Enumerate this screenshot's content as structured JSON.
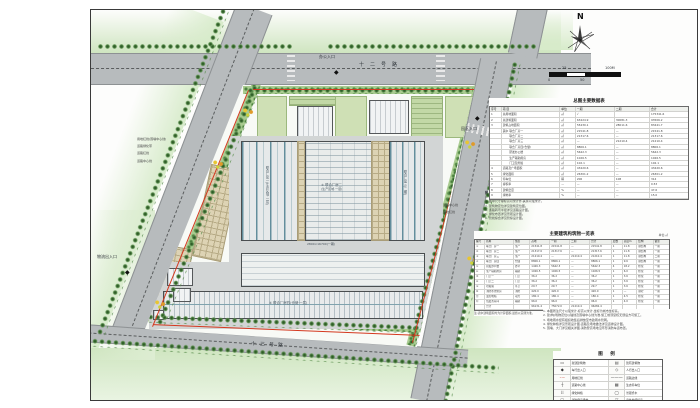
{
  "sheet": {
    "compass": {
      "north_label": "N"
    },
    "scalebar": {
      "label_0": "0",
      "label_25": "25",
      "label_50": "50",
      "label_100": "100M"
    },
    "plan": {
      "road_top": "十二号路",
      "road_bottom": "十三号路",
      "entrance_office": "办公入口",
      "entrance_park": "园区入口",
      "entrance_logistics": "物流出入口",
      "left_leaders": [
        "用地红线(围墙中心线)",
        "道路绿化带",
        "道路红线",
        "道路中心线"
      ],
      "right_leaders": [
        "道路中心线",
        "用地红线"
      ],
      "f1_label": "联合厂房一(生产区域·一层)",
      "f2_label_1": "② 联合厂房二",
      "f2_label_2": "(生产区域·一层)",
      "f3_label": "联合厂房三(二期)",
      "f4_label": "④ 联合厂房四(仓储·一层)",
      "yard_dim": "2800×16700(一期)"
    },
    "table1": {
      "title": "总图主要数据表",
      "rows": [
        [
          "序号",
          "项  目",
          "单位",
          "一期",
          "二期",
          "合计"
        ],
        [
          "1",
          "总用地面积",
          "㎡",
          "√",
          "",
          "175341.6"
        ],
        [
          "2",
          "总建筑面积",
          "㎡",
          "63424.9",
          "30081.3",
          "93506.2"
        ],
        [
          "3",
          "建筑占地面积",
          "㎡",
          "55430.1",
          "28011.6",
          "83441.7"
        ],
        [
          "",
          "其中 联合厂房一",
          "㎡",
          "21541.8",
          "—",
          "21541.8"
        ],
        [
          "",
          "　　 联合厂房二",
          "㎡",
          "21317.6",
          "—",
          "21317.6"
        ],
        [
          "",
          "　　 联合厂房三",
          "㎡",
          "—",
          "21210.4",
          "21210.4"
        ],
        [
          "",
          "　　 联合厂房四(仓储)",
          "㎡",
          "8806.1",
          "—",
          "8806.1"
        ],
        [
          "",
          "　　 研发办公楼",
          "㎡",
          "5642.3",
          "—",
          "5642.3"
        ],
        [
          "",
          "　　 生产辅助用房",
          "㎡",
          "1026.5",
          "—",
          "1026.5"
        ],
        [
          "",
          "　　 门卫及附属",
          "㎡",
          "102.1",
          "—",
          "102.1"
        ],
        [
          "4",
          "道路及广场面积",
          "㎡",
          "43420.6",
          "—",
          "43420.6"
        ],
        [
          "5",
          "绿化面积",
          "㎡",
          "26301.2",
          "—",
          "26301.2"
        ],
        [
          "6",
          "停车位",
          "辆",
          "206",
          "108",
          "314"
        ],
        [
          "7",
          "容积率",
          "—",
          "—",
          "—",
          "0.53"
        ],
        [
          "8",
          "建筑密度",
          "%",
          "—",
          "—",
          "47.6"
        ],
        [
          "9",
          "绿地率",
          "%",
          "—",
          "—",
          "15.0"
        ]
      ]
    },
    "notes_list": {
      "title": "附 注:",
      "items": [
        "1. 本图坐标采用城市坐标系,高程为黄海高程。",
        "2. 图中尺寸除标高以米计外,其余以毫米计。",
        "3. 建筑物定位详见建筑定位图。",
        "4. 道路转弯半径详见道路设计图。",
        "5. 绿化布置详见景观设计图。",
        "6. 管线综合详见管综设计图。"
      ]
    },
    "table2": {
      "title": "主要建筑构筑物一览表",
      "unit_note": "单位:㎡",
      "rows": [
        [
          "编号",
          "名称",
          "性质",
          "占地",
          "一期",
          "二期",
          "合计",
          "层数",
          "高度m",
          "结构",
          "备注"
        ],
        [
          "①",
          "联合厂房一",
          "生产",
          "21541.8",
          "21541.8",
          "—",
          "21541.8",
          "1",
          "11.8",
          "钢结构",
          "一期"
        ],
        [
          "②",
          "联合厂房二",
          "生产",
          "21317.6",
          "21317.6",
          "—",
          "21317.6",
          "1",
          "11.8",
          "钢结构",
          "一期"
        ],
        [
          "③",
          "联合厂房三",
          "生产",
          "21210.4",
          "—",
          "21210.4",
          "21210.4",
          "1",
          "11.8",
          "钢结构",
          "二期"
        ],
        [
          "④",
          "联合厂房四",
          "仓储",
          "8806.1",
          "8806.1",
          "—",
          "8806.1",
          "1",
          "9.6",
          "钢结构",
          "一期"
        ],
        [
          "⑤",
          "研发办公楼",
          "办公",
          "1426.3",
          "5642.3",
          "—",
          "5642.3",
          "4",
          "18.2",
          "框架",
          "一期"
        ],
        [
          "⑥",
          "生产辅助用房",
          "辅助",
          "1026.5",
          "1026.5",
          "—",
          "1026.5",
          "1",
          "6.0",
          "框架",
          "一期"
        ],
        [
          "⑦",
          "门卫一",
          "门卫",
          "36.2",
          "36.2",
          "—",
          "36.2",
          "1",
          "3.6",
          "框架",
          "一期"
        ],
        [
          "⑧",
          "门卫二",
          "门卫",
          "36.2",
          "36.2",
          "—",
          "36.2",
          "1",
          "3.6",
          "框架",
          "一期"
        ],
        [
          "⑨",
          "垃圾站",
          "环卫",
          "29.7",
          "29.7",
          "—",
          "29.7",
          "1",
          "3.6",
          "框架",
          "一期"
        ],
        [
          "⑩",
          "消防水池泵房",
          "消防",
          "420.0",
          "420.0",
          "—",
          "420.0",
          "1",
          "—",
          "钢砼",
          "一期"
        ],
        [
          "⑪",
          "变配电站",
          "动力",
          "180.4",
          "180.4",
          "—",
          "180.4",
          "1",
          "4.5",
          "框架",
          "一期"
        ],
        [
          "⑫",
          "危废暂存间",
          "辅助",
          "96.0",
          "96.0",
          "—",
          "96.0",
          "1",
          "4.0",
          "框架",
          "一期"
        ],
        [
          "",
          "合计",
          "",
          "96131.4",
          "75072.0",
          "21210.4",
          "96282.4",
          "",
          "",
          "",
          ""
        ]
      ],
      "footnote": "注:表中建筑面积均为计算面积,最终以实测为准。"
    },
    "notes": {
      "items": [
        "1. 本图所注尺寸以毫米计,标高以米计,坐标为城市坐标系。",
        "2. 建(构)筑物定位以轴线及围墙中心线为准,施工前须复核无误后方可施工。",
        "3. 场地雨水经有组织收集后排放至市政雨水管网。",
        "4. 绿化种植详见景观设计图,道路及场地做法详见道排设计图。",
        "5. 围墙、大门详见相关详图,消防登高场地沿环形消防车道布置。"
      ]
    },
    "legend": {
      "title": "图  例",
      "rows": [
        [
          "▭",
          "新建建筑物",
          "▤",
          "既有建筑物"
        ],
        [
          "◆",
          "车行出入口",
          "◇",
          "人行出入口"
        ],
        [
          "–·–",
          "用地红线",
          "———",
          "道路边线"
        ],
        [
          "┼",
          "道路中心线",
          "▦",
          "生态停车位"
        ],
        [
          "⠿",
          "绿化种植",
          "◯",
          "景观乔木"
        ],
        [
          "▢",
          "消防登高场地",
          "▽",
          "室外地坪标高"
        ],
        [
          "▫",
          "雨水口",
          "✳",
          "庭院灯"
        ]
      ]
    }
  }
}
